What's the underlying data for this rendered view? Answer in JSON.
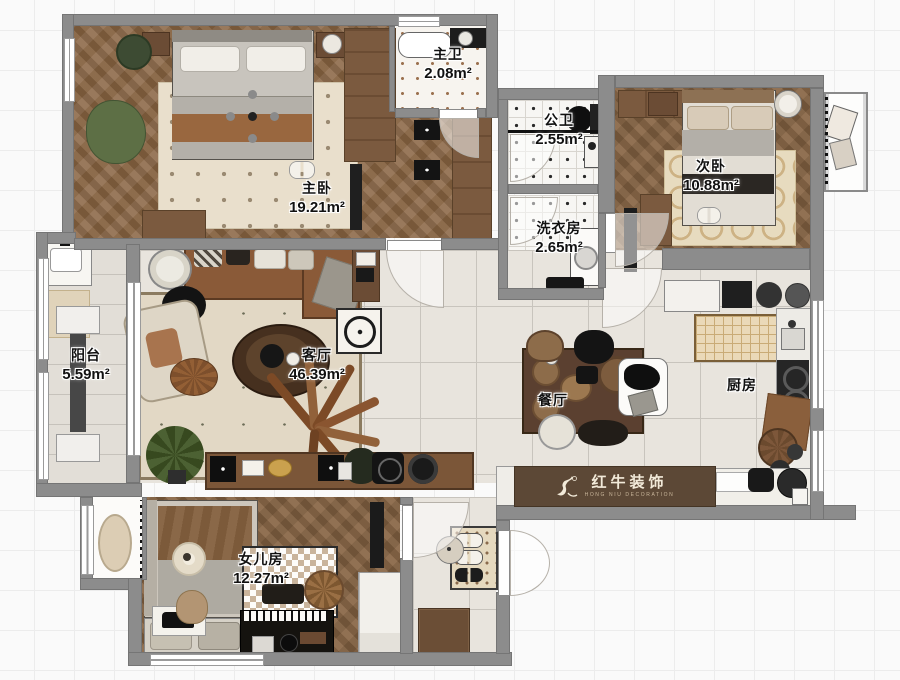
{
  "title": "apartment-floorplan",
  "rooms": [
    {
      "id": "master_bedroom",
      "label": "主卧",
      "area": "19.21m²"
    },
    {
      "id": "master_bath",
      "label": "主卫",
      "area": "2.08m²"
    },
    {
      "id": "guest_bath",
      "label": "公卫",
      "area": "2.55m²"
    },
    {
      "id": "laundry",
      "label": "洗衣房",
      "area": "2.65m²"
    },
    {
      "id": "second_bedroom",
      "label": "次卧",
      "area": "10.88m²"
    },
    {
      "id": "living_room",
      "label": "客厅",
      "area": "46.39m²"
    },
    {
      "id": "dining_room",
      "label": "餐厅",
      "area": ""
    },
    {
      "id": "kitchen",
      "label": "厨房",
      "area": ""
    },
    {
      "id": "balcony",
      "label": "阳台",
      "area": "5.59m²"
    },
    {
      "id": "daughter_room",
      "label": "女儿房",
      "area": "12.27m²"
    }
  ],
  "watermark": {
    "brand": "红牛装饰",
    "brand_en": "HONG NIU DECORATION"
  },
  "colors": {
    "wall": "#8c8c8c",
    "wood": "#8a6848",
    "tile": "#e8e4dd",
    "label_text": "#111111",
    "logo_bg": "#5c4836",
    "logo_text": "#f2ead9"
  }
}
